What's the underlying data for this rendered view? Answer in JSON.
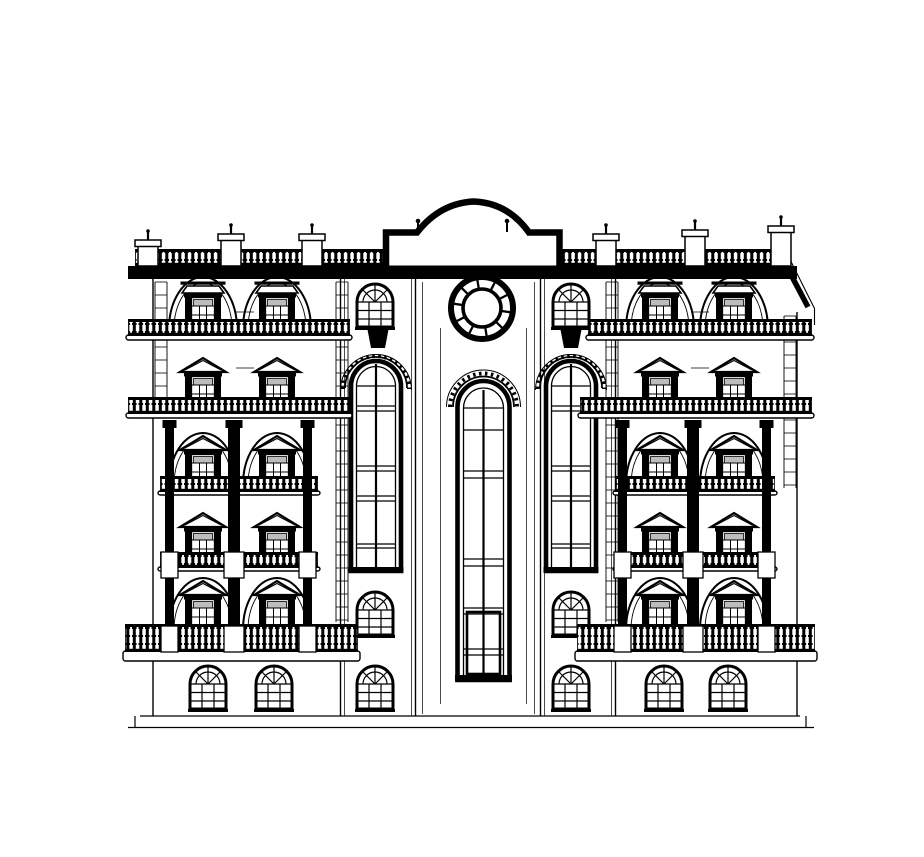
{
  "drawing": {
    "title": "Classical building facade - front elevation (black and white CAD line drawing)",
    "medium": "architectural elevation, ink on white, no text or dimensions shown",
    "palette": {
      "ink": "#000000",
      "paper": "#ffffff",
      "glass_shade": "#bdbdbd"
    },
    "inventory": {
      "stories": 6,
      "wings": 2,
      "stair_towers": 2,
      "pediment_windows": 20,
      "fanlight_windows": 10,
      "tall_arched_windows": 2,
      "central_arched_window": 1,
      "rosette_windows": 1,
      "balustrade_bands": 12
    },
    "facade": {
      "window_columns_left_wing_x": [
        140,
        214
      ],
      "window_columns_right_wing_x": [
        597,
        671
      ],
      "pediment_window_rows": [
        {
          "y": 263,
          "style": "flat-pediment",
          "arched_recess": true
        },
        {
          "y": 341,
          "style": "triangle-pediment",
          "arched_recess": false
        },
        {
          "y": 419,
          "style": "triangle-pediment",
          "arched_recess": true
        },
        {
          "y": 496,
          "style": "triangle-pediment",
          "arched_recess": false
        },
        {
          "y": 564,
          "style": "triangle-pediment",
          "arched_recess": true
        }
      ],
      "ground_fanlight_windows": [
        {
          "x": 148,
          "y": 648
        },
        {
          "x": 214,
          "y": 648
        },
        {
          "x": 604,
          "y": 648
        },
        {
          "x": 668,
          "y": 648
        }
      ],
      "tower_fanlight_windows": [
        {
          "x": 315,
          "y": 266
        },
        {
          "x": 511,
          "y": 266
        },
        {
          "x": 315,
          "y": 574
        },
        {
          "x": 511,
          "y": 574
        },
        {
          "x": 315,
          "y": 648
        },
        {
          "x": 511,
          "y": 648
        }
      ],
      "tall_arched_windows": [
        {
          "x": 308,
          "y": 332
        },
        {
          "x": 503,
          "y": 332
        }
      ],
      "rosette_window": {
        "cx": 442,
        "cy": 292,
        "outer_r": 31,
        "inner_r": 19,
        "spokes": 10
      },
      "balustrade_bands": [
        {
          "name": "parapet-left",
          "x": 95,
          "y": 233,
          "w": 250,
          "h": 17,
          "slab": 0
        },
        {
          "name": "parapet-right",
          "x": 520,
          "y": 233,
          "w": 231,
          "h": 17,
          "slab": 0
        },
        {
          "name": "balcony-l2",
          "x": 88,
          "y": 303,
          "w": 222,
          "h": 17,
          "slab": 5
        },
        {
          "name": "balcony-r2",
          "x": 548,
          "y": 303,
          "w": 224,
          "h": 17,
          "slab": 5
        },
        {
          "name": "balcony-l3",
          "x": 88,
          "y": 381,
          "w": 222,
          "h": 17,
          "slab": 5
        },
        {
          "name": "balcony-r3",
          "x": 540,
          "y": 381,
          "w": 232,
          "h": 17,
          "slab": 5
        },
        {
          "name": "balcony-l4",
          "x": 120,
          "y": 460,
          "w": 158,
          "h": 16,
          "slab": 4
        },
        {
          "name": "balcony-r4",
          "x": 575,
          "y": 460,
          "w": 160,
          "h": 16,
          "slab": 4
        },
        {
          "name": "balcony-l5",
          "x": 120,
          "y": 536,
          "w": 158,
          "h": 16,
          "slab": 4
        },
        {
          "name": "balcony-r5",
          "x": 575,
          "y": 536,
          "w": 160,
          "h": 16,
          "slab": 4
        },
        {
          "name": "balcony-l6",
          "x": 85,
          "y": 608,
          "w": 233,
          "h": 28,
          "slab": 10
        },
        {
          "name": "balcony-r6",
          "x": 537,
          "y": 608,
          "w": 238,
          "h": 28,
          "slab": 10
        }
      ],
      "pilasters": [
        {
          "x": 125,
          "y": 404,
          "w": 9,
          "h": 208
        },
        {
          "x": 188,
          "y": 404,
          "w": 12,
          "h": 208
        },
        {
          "x": 263,
          "y": 404,
          "w": 9,
          "h": 208
        },
        {
          "x": 578,
          "y": 404,
          "w": 9,
          "h": 208
        },
        {
          "x": 647,
          "y": 404,
          "w": 12,
          "h": 208
        },
        {
          "x": 722,
          "y": 404,
          "w": 9,
          "h": 208
        }
      ],
      "pilaster_pedestal_y": [
        536,
        610
      ],
      "parapet_pedestals": [
        {
          "x": 98,
          "y": 222
        },
        {
          "x": 181,
          "y": 216
        },
        {
          "x": 262,
          "y": 216
        },
        {
          "x": 556,
          "y": 216
        },
        {
          "x": 645,
          "y": 212
        },
        {
          "x": 731,
          "y": 208
        }
      ],
      "quoin_ladders": [
        {
          "x1": 115,
          "x2": 127,
          "y1": 266,
          "y2": 398
        },
        {
          "x1": 296,
          "x2": 308,
          "y1": 266,
          "y2": 606
        },
        {
          "x1": 566,
          "x2": 578,
          "y1": 266,
          "y2": 606
        },
        {
          "x1": 744,
          "x2": 756,
          "y1": 300,
          "y2": 472
        }
      ],
      "rung_step": 13
    }
  }
}
